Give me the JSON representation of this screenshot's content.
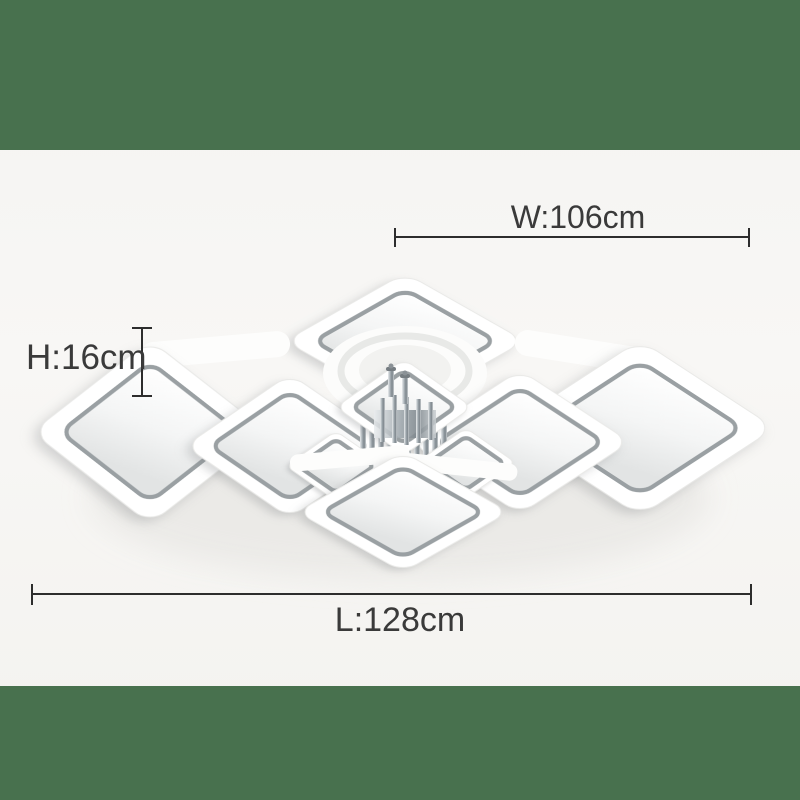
{
  "product_image": {
    "subject": "led-square-ring-ceiling-chandelier",
    "rings_count": 9
  },
  "annotations": {
    "width": "W:106cm",
    "height": "H:16cm",
    "length": "L:128cm"
  },
  "colors": {
    "band_green": "#48714e",
    "content_background": "#f6f5f3",
    "annotation_text": "#3a3a3a",
    "dimension_line": "#2d2d2d",
    "lamp_frame_white": "#ffffff",
    "lamp_ring_gray": "#9aa0a3"
  }
}
